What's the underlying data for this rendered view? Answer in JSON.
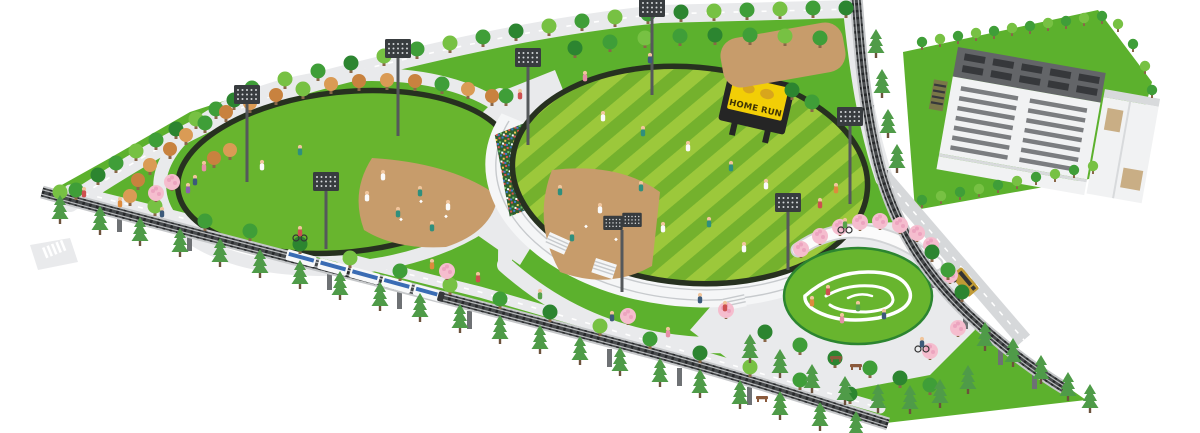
{
  "scoreboard": {
    "text": "HOME RUN"
  },
  "landmarks": [
    "west-ballfield",
    "main-stadium",
    "grandstand",
    "crowd-stands",
    "practice-field",
    "sports-center-building",
    "cherry-blossom-garden",
    "lawn-plaza",
    "elevated-railway-south",
    "elevated-railway-east",
    "commuter-train",
    "shuttle-bus",
    "access-road",
    "floodlights",
    "promenade",
    "crosswalks"
  ],
  "colors": {
    "bg": "#ffffff",
    "park": "#5cb12d",
    "field": "#68b52e",
    "rim": "#273120",
    "stripe_light": "#9cc83b",
    "stripe_dark": "#74b12d",
    "dirt": "#c79c6b",
    "path": "#e9eaec",
    "road": "#d6d8da",
    "dash": "#ffffff",
    "stand": "#f5f6f7",
    "stand_step": "#c7cacd",
    "crowd_bg": "#2f5f2f",
    "crowd1": "#e0534e",
    "crowd2": "#3f7ad1",
    "crowd3": "#f0c94f",
    "crowd4": "#6fc06f",
    "crowd5": "#ffffff",
    "deck": "#c6c8ca",
    "rail": "#474a4c",
    "tie": "#26282a",
    "rail_light": "#b8babc",
    "pillar": "#6e7174",
    "train": "#f7f8f9",
    "train_band": "#3a6cb4",
    "train_dark": "#35373a",
    "bus": "#c09a35",
    "bus_dark": "#343434",
    "roof": "#636568",
    "slit": "#36383b",
    "wall": "#f1f2f3",
    "wall_side": "#d8dadc",
    "win": "#7b7d80",
    "panel": "#c9ae85",
    "louver": "#7a7748",
    "score_frame": "#252525",
    "screen": "#f2ce06",
    "score_text": "#3f3305",
    "mascot": "#d8a61c",
    "pole": "#55585b",
    "light_head": "#383c3f",
    "light_dot": "#d3d6d8",
    "t1": "#3f9e38",
    "t2": "#77c143",
    "t3": "#2c8530",
    "trunk": "#8a6748",
    "a1": "#c8823f",
    "a2": "#da9b55",
    "pine": "#4f9b48",
    "pine_trunk": "#6c523c",
    "blossom": "#f5bdce",
    "blossom2": "#eca4bf",
    "pergola": "#fbfbfb",
    "pergola_edge": "#d2d4d6",
    "swirl": "#ffffff",
    "skin": "#f0c59c",
    "bench": "#8b5a3c",
    "pW": "#fafafa",
    "pT": "#2f8f7d",
    "p1": "#cd5050",
    "p2": "#3c5a7a",
    "p3": "#dd8b3d",
    "p4": "#57a24a",
    "p5": "#e590a6",
    "p6": "#8a5fb0"
  }
}
